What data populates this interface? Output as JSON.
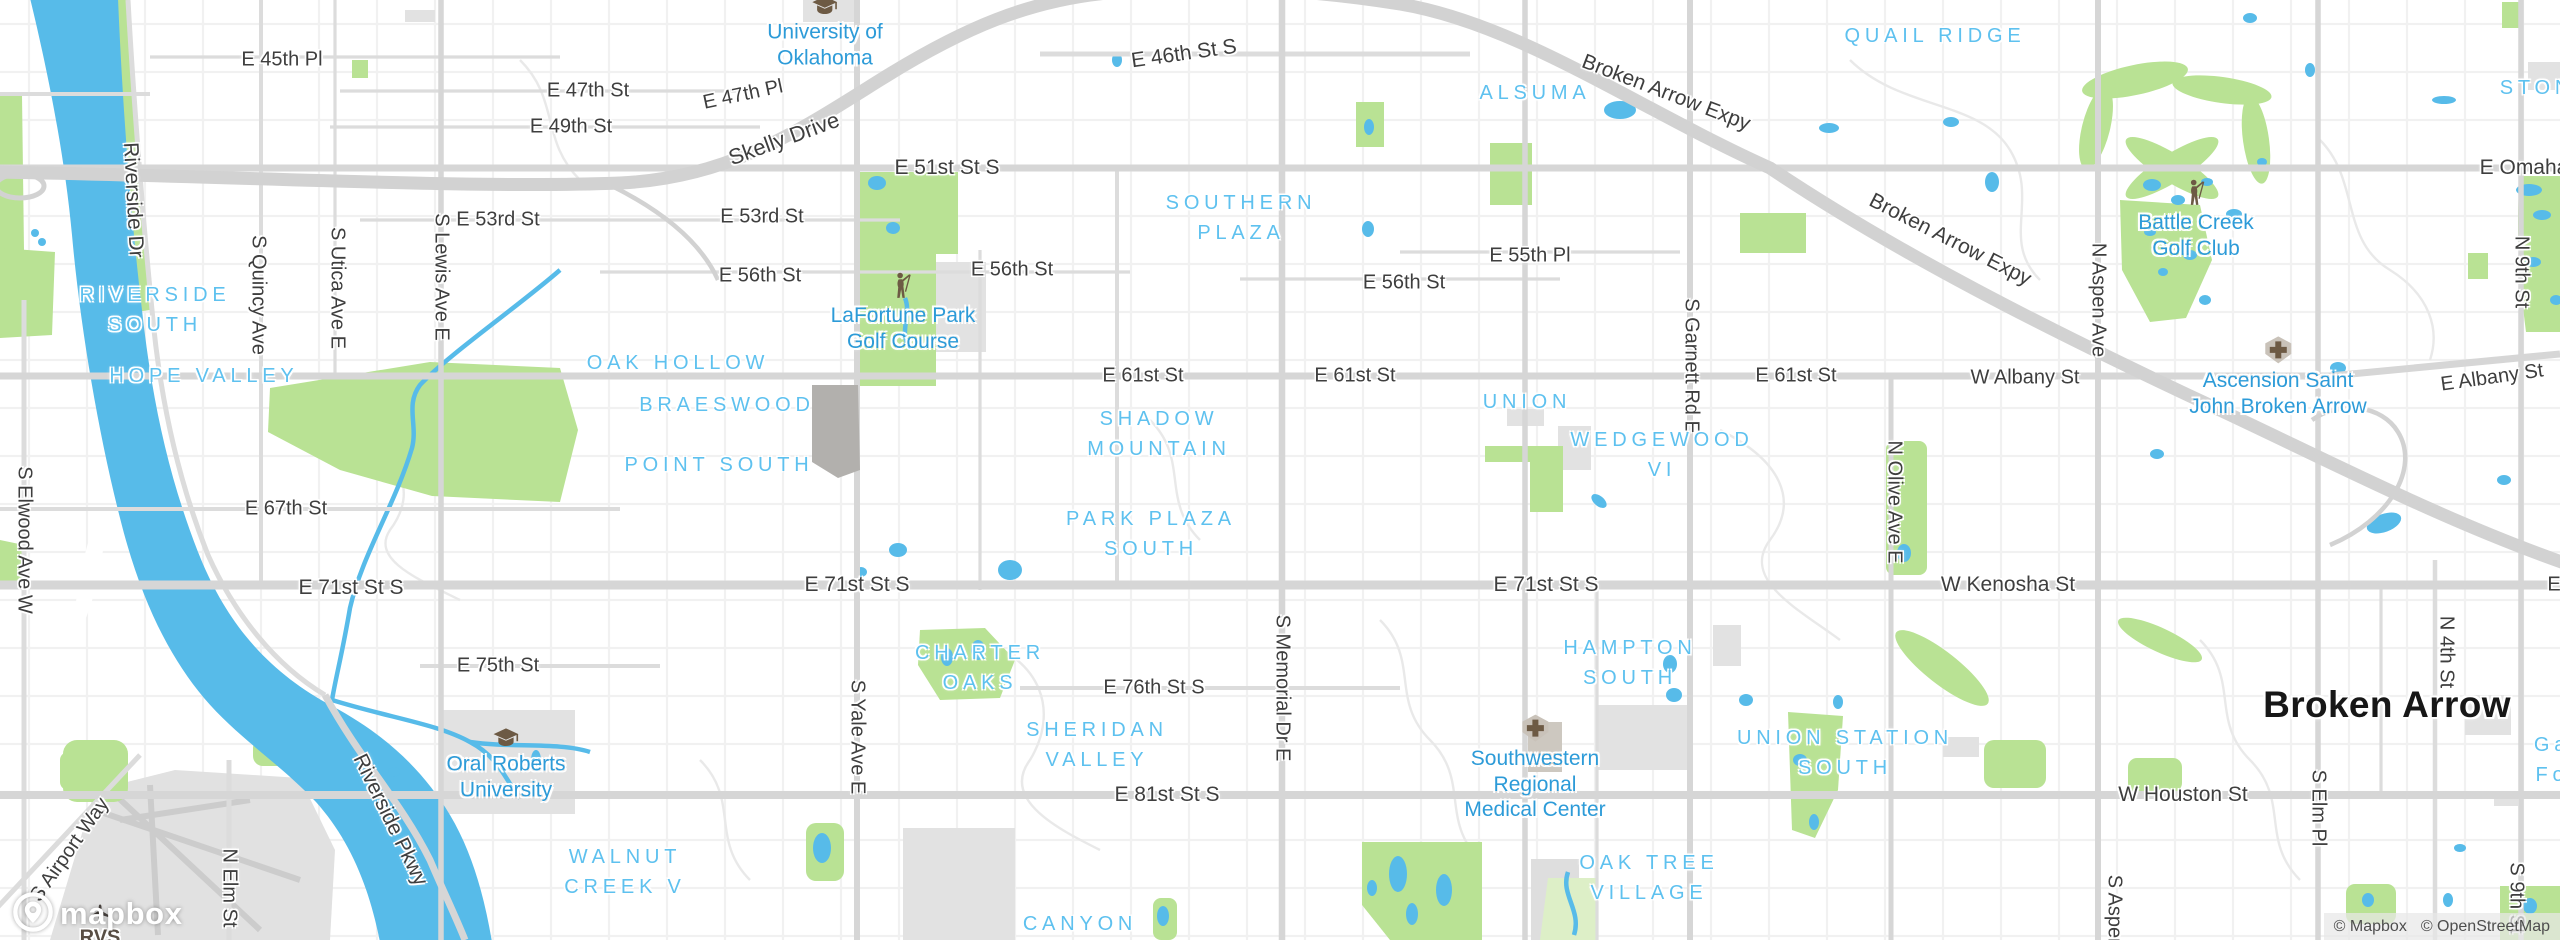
{
  "map": {
    "colors": {
      "water": "#57bbe9",
      "park": "#b9e294",
      "park_pale": "#ddefc7",
      "road_major": "#d6d6d6",
      "highway": "#d2d2d2",
      "neighborhood_text": "#5ec1ef",
      "poi_text": "#2d9bd8",
      "street_text": "#3e3e3e",
      "city_text": "#171717",
      "poi_icon_brown": "#6d5a44",
      "airport_text": "#584e44"
    },
    "labels": {
      "streets": [
        {
          "t": "E 45th Pl",
          "x": 282,
          "y": 60
        },
        {
          "t": "E 47th St",
          "x": 588,
          "y": 91
        },
        {
          "t": "E 47th Pl",
          "x": 743,
          "y": 95,
          "r": -12
        },
        {
          "t": "E 49th St",
          "x": 571,
          "y": 127
        },
        {
          "t": "Skelly Drive",
          "x": 784,
          "y": 139,
          "r": -20,
          "s": 22
        },
        {
          "t": "E 46th St S",
          "x": 1184,
          "y": 54,
          "r": -8,
          "s": 21
        },
        {
          "t": "E 51st St S",
          "x": 947,
          "y": 168,
          "s": 21
        },
        {
          "t": "E 53rd St",
          "x": 498,
          "y": 220
        },
        {
          "t": "E 53rd St",
          "x": 762,
          "y": 217
        },
        {
          "t": "E 56th St",
          "x": 760,
          "y": 276
        },
        {
          "t": "E 56th St",
          "x": 1012,
          "y": 270
        },
        {
          "t": "E 56th St",
          "x": 1404,
          "y": 283
        },
        {
          "t": "E 55th Pl",
          "x": 1530,
          "y": 256
        },
        {
          "t": "Broken Arrow Expy",
          "x": 1666,
          "y": 93,
          "r": 21,
          "s": 21
        },
        {
          "t": "Broken Arrow Expy",
          "x": 1950,
          "y": 240,
          "r": 27,
          "s": 21
        },
        {
          "t": "E Omaha",
          "x": 2524,
          "y": 168,
          "s": 21
        },
        {
          "t": "E 61st St",
          "x": 1143,
          "y": 376
        },
        {
          "t": "E 61st St",
          "x": 1355,
          "y": 376
        },
        {
          "t": "E 61st St",
          "x": 1796,
          "y": 376
        },
        {
          "t": "W Albany St",
          "x": 2025,
          "y": 378
        },
        {
          "t": "E Albany St",
          "x": 2492,
          "y": 378,
          "r": -8
        },
        {
          "t": "E 67th St",
          "x": 286,
          "y": 509
        },
        {
          "t": "E 71st St S",
          "x": 351,
          "y": 588,
          "s": 21
        },
        {
          "t": "E 71st St S",
          "x": 857,
          "y": 585,
          "s": 21
        },
        {
          "t": "E 71st St S",
          "x": 1546,
          "y": 585,
          "s": 21
        },
        {
          "t": "W Kenosha St",
          "x": 2008,
          "y": 585,
          "s": 21
        },
        {
          "t": "E",
          "x": 2554,
          "y": 585
        },
        {
          "t": "E 75th St",
          "x": 498,
          "y": 666
        },
        {
          "t": "E 76th St S",
          "x": 1154,
          "y": 688
        },
        {
          "t": "E 81st St S",
          "x": 1167,
          "y": 795,
          "s": 21
        },
        {
          "t": "W Houston St",
          "x": 2183,
          "y": 795,
          "s": 21
        },
        {
          "t": "Riverside Dr",
          "x": 133,
          "y": 200,
          "r": 87,
          "s": 21
        },
        {
          "t": "Riverside Pkwy",
          "x": 390,
          "y": 820,
          "r": 64,
          "s": 21
        },
        {
          "t": "S Airport Way",
          "x": 70,
          "y": 850,
          "r": -55
        },
        {
          "t": "S Quincy Ave",
          "x": 258,
          "y": 295,
          "r": 90
        },
        {
          "t": "S Utica Ave E",
          "x": 337,
          "y": 288,
          "r": 90
        },
        {
          "t": "S Lewis Ave E",
          "x": 441,
          "y": 277,
          "r": 90
        },
        {
          "t": "S Elwood Ave W",
          "x": 24,
          "y": 540,
          "r": 90
        },
        {
          "t": "S Yale Ave E",
          "x": 857,
          "y": 737,
          "r": 90
        },
        {
          "t": "S Memorial Dr E",
          "x": 1282,
          "y": 688,
          "r": 90
        },
        {
          "t": "S Garnett Rd E",
          "x": 1691,
          "y": 366,
          "r": 90
        },
        {
          "t": "N Aspen Ave",
          "x": 2098,
          "y": 300,
          "r": 90
        },
        {
          "t": "N Olive Ave E",
          "x": 1894,
          "y": 502,
          "r": 90
        },
        {
          "t": "N 4th St",
          "x": 2446,
          "y": 652,
          "r": 90
        },
        {
          "t": "N 9th St",
          "x": 2521,
          "y": 272,
          "r": 90
        },
        {
          "t": "S 9th St",
          "x": 2516,
          "y": 898,
          "r": 90
        },
        {
          "t": "N Elm St",
          "x": 229,
          "y": 888,
          "r": 90
        },
        {
          "t": "S Elm Pl",
          "x": 2318,
          "y": 808,
          "r": 90
        },
        {
          "t": "S Aspen",
          "x": 2114,
          "y": 912,
          "r": 90
        }
      ],
      "neighborhoods": [
        {
          "lines": [
            "RIVERSIDE",
            "SOUTH"
          ],
          "x": 155,
          "y": 310
        },
        {
          "t": "HOPE VALLEY",
          "x": 204,
          "y": 376
        },
        {
          "t": "OAK HOLLOW",
          "x": 678,
          "y": 363
        },
        {
          "t": "BRAESWOOD",
          "x": 727,
          "y": 405
        },
        {
          "t": "POINT SOUTH",
          "x": 719,
          "y": 465
        },
        {
          "lines": [
            "SOUTHERN",
            "PLAZA"
          ],
          "x": 1241,
          "y": 218
        },
        {
          "t": "ALSUMA",
          "x": 1535,
          "y": 93
        },
        {
          "t": "QUAIL RIDGE",
          "x": 1935,
          "y": 36
        },
        {
          "t": "STONE",
          "x": 2546,
          "y": 88
        },
        {
          "t": "UNION",
          "x": 1527,
          "y": 402
        },
        {
          "lines": [
            "WEDGEWOOD",
            "VI"
          ],
          "x": 1662,
          "y": 455
        },
        {
          "lines": [
            "SHADOW",
            "MOUNTAIN"
          ],
          "x": 1159,
          "y": 434
        },
        {
          "lines": [
            "PARK PLAZA",
            "SOUTH"
          ],
          "x": 1151,
          "y": 534
        },
        {
          "lines": [
            "CHARTER",
            "OAKS"
          ],
          "x": 980,
          "y": 668
        },
        {
          "lines": [
            "SHERIDAN",
            "VALLEY"
          ],
          "x": 1097,
          "y": 745
        },
        {
          "lines": [
            "HAMPTON",
            "SOUTH"
          ],
          "x": 1630,
          "y": 663
        },
        {
          "lines": [
            "UNION STATION",
            "SOUTH"
          ],
          "x": 1845,
          "y": 753
        },
        {
          "lines": [
            "OAK TREE",
            "VILLAGE"
          ],
          "x": 1649,
          "y": 878
        },
        {
          "lines": [
            "WALNUT",
            "CREEK V"
          ],
          "x": 625,
          "y": 872
        },
        {
          "t": "CANYON",
          "x": 1080,
          "y": 924
        },
        {
          "lines": [
            "Ga",
            "Fo"
          ],
          "x": 2552,
          "y": 760
        }
      ],
      "pois": [
        {
          "lines": [
            "University of",
            "Oklahoma"
          ],
          "x": 825,
          "y": 33,
          "icon": "school-icon"
        },
        {
          "lines": [
            "LaFortune Park",
            "Golf Course"
          ],
          "x": 903,
          "y": 313,
          "icon": "golfer-icon"
        },
        {
          "lines": [
            "Battle Creek",
            "Golf Club"
          ],
          "x": 2196,
          "y": 220,
          "icon": "golfer-icon"
        },
        {
          "lines": [
            "Ascension Saint",
            "John Broken Arrow"
          ],
          "x": 2278,
          "y": 377,
          "icon": "hospital-icon"
        },
        {
          "lines": [
            "Oral Roberts",
            "University"
          ],
          "x": 506,
          "y": 765,
          "icon": "school-icon"
        },
        {
          "lines": [
            "Southwestern",
            "Regional",
            "Medical Center"
          ],
          "x": 1535,
          "y": 768,
          "icon": "hospital-icon"
        }
      ],
      "city": {
        "t": "Broken Arrow",
        "x": 2387,
        "y": 705
      },
      "airport": {
        "t": "RVS",
        "x": 100,
        "y": 927,
        "icon": "plane-icon"
      }
    }
  },
  "logo": {
    "text": "mapbox"
  },
  "attribution": {
    "mapbox": "© Mapbox",
    "osm": "© OpenStreetMap"
  }
}
